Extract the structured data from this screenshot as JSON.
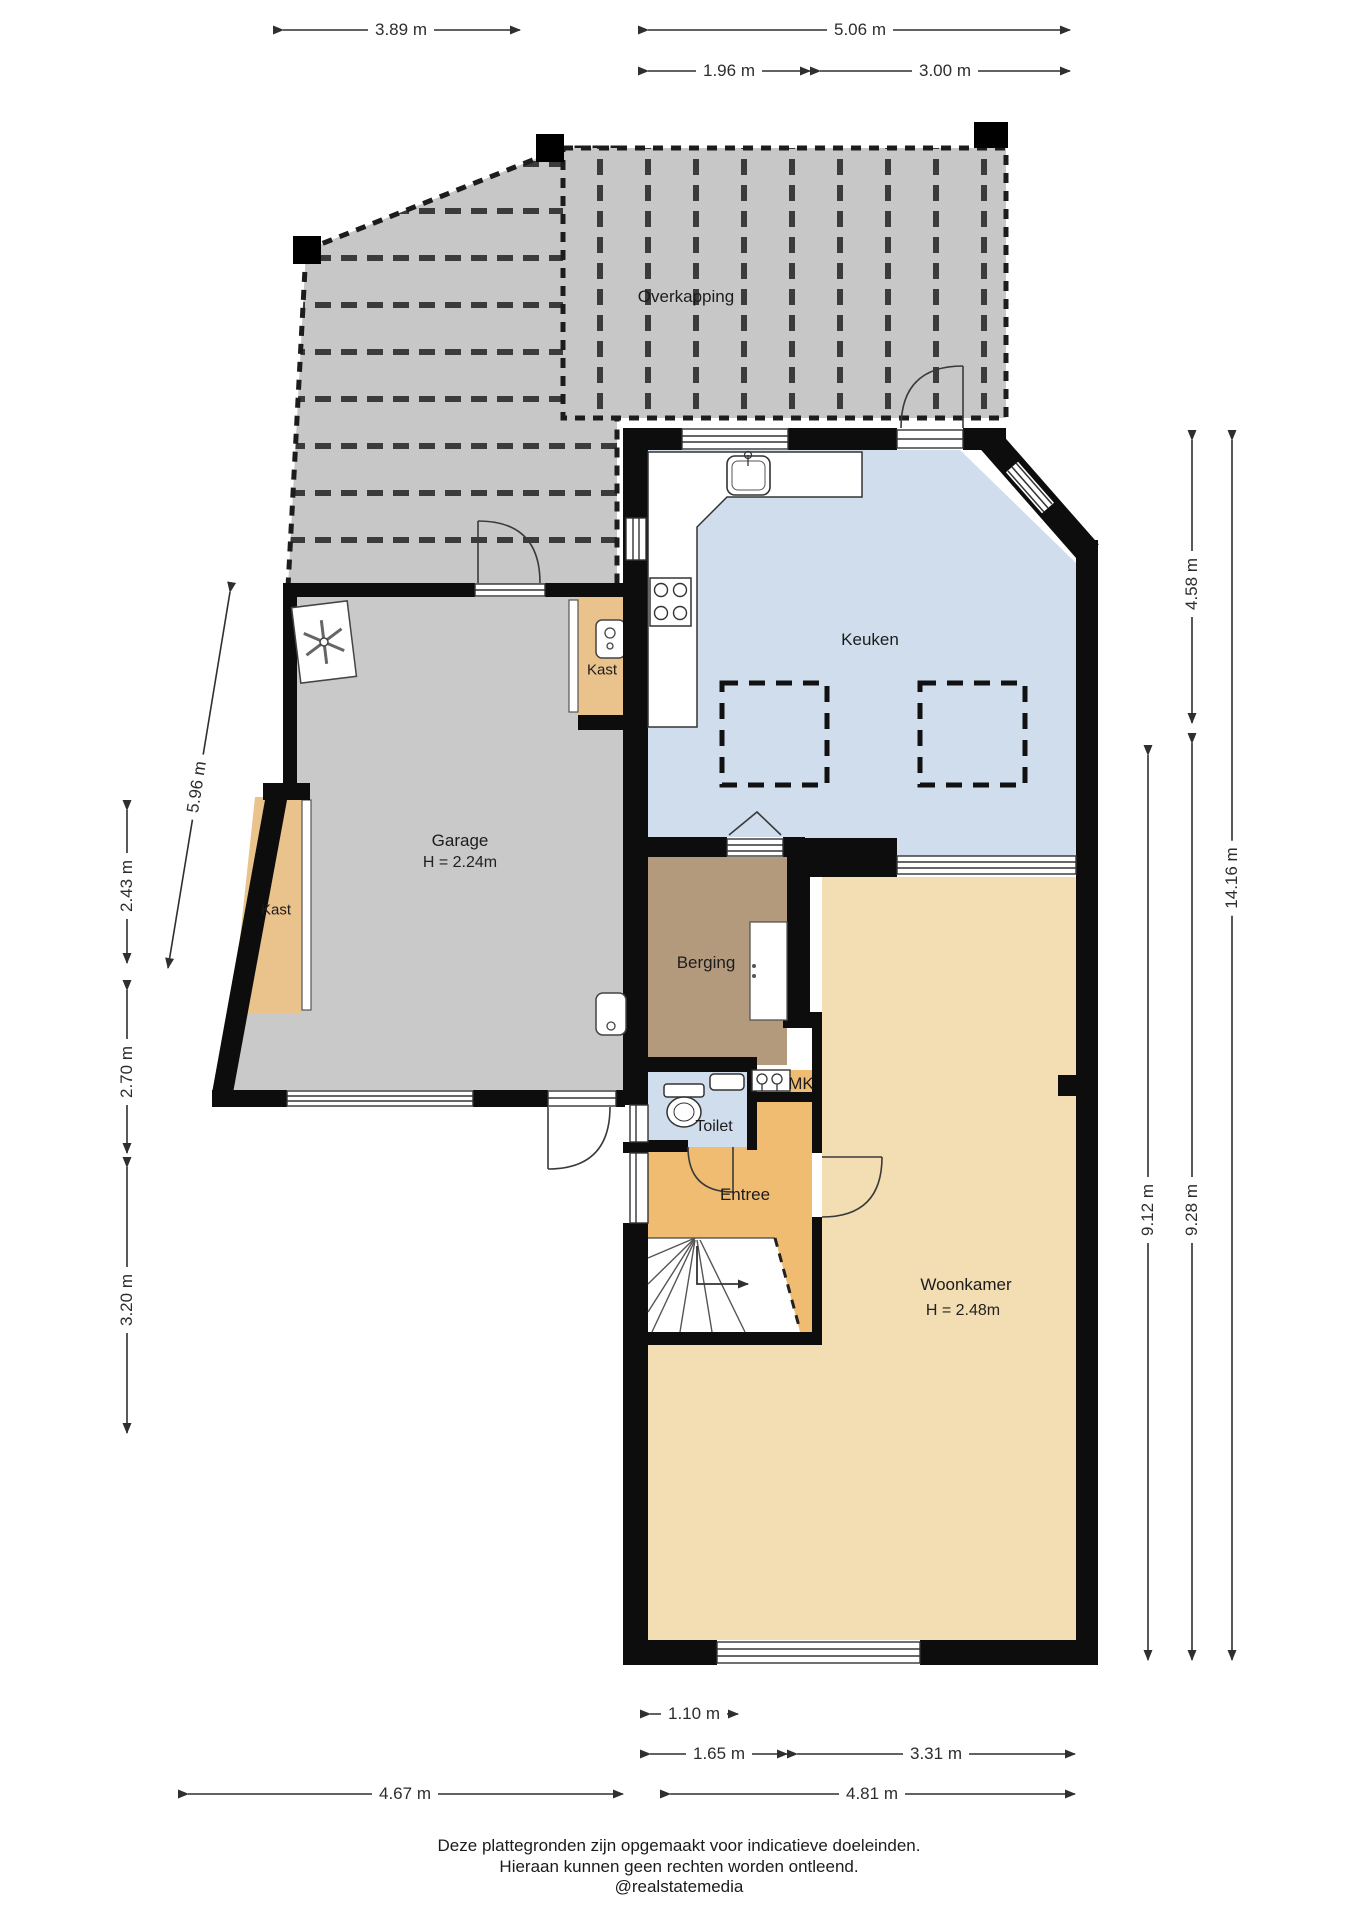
{
  "title": "Floor plan begane grond",
  "colors": {
    "wall": "#0d0d0d",
    "overkapping": "#c7c7c7",
    "garage": "#c9c9c9",
    "keuken": "#cfddec",
    "toilet": "#cfddec",
    "berging": "#b49a7d",
    "kast": "#e9c28c",
    "entree": "#f0bc72",
    "woonkamer": "#f3ddb3"
  },
  "rooms": {
    "overkapping": "Overkapping",
    "keuken": "Keuken",
    "kast_keuken": "Kast",
    "garage": "Garage",
    "garage_height": "H = 2.24m",
    "kast_garage": "Kast",
    "berging": "Berging",
    "toilet": "Toilet",
    "mk": "MK",
    "entree": "Entree",
    "woonkamer": "Woonkamer",
    "woonkamer_height": "H = 2.48m"
  },
  "dimensions": {
    "top": [
      {
        "label": "3.89 m"
      },
      {
        "label": "5.06 m"
      },
      {
        "label": "1.96 m"
      },
      {
        "label": "3.00 m"
      }
    ],
    "right": [
      {
        "label": "4.58 m"
      },
      {
        "label": "14.16 m"
      },
      {
        "label": "9.12 m"
      },
      {
        "label": "9.28 m"
      }
    ],
    "left": [
      {
        "label": "5.96 m"
      },
      {
        "label": "2.43 m"
      },
      {
        "label": "2.70 m"
      },
      {
        "label": "3.20 m"
      }
    ],
    "bottom": [
      {
        "label": "1.10 m"
      },
      {
        "label": "1.65 m"
      },
      {
        "label": "3.31 m"
      },
      {
        "label": "4.67 m"
      },
      {
        "label": "4.81 m"
      }
    ]
  },
  "footer": {
    "line1": "Deze plattegronden zijn opgemaakt voor indicatieve doeleinden.",
    "line2": "Hieraan kunnen geen rechten worden ontleend.",
    "line3": "@realstatemedia"
  }
}
